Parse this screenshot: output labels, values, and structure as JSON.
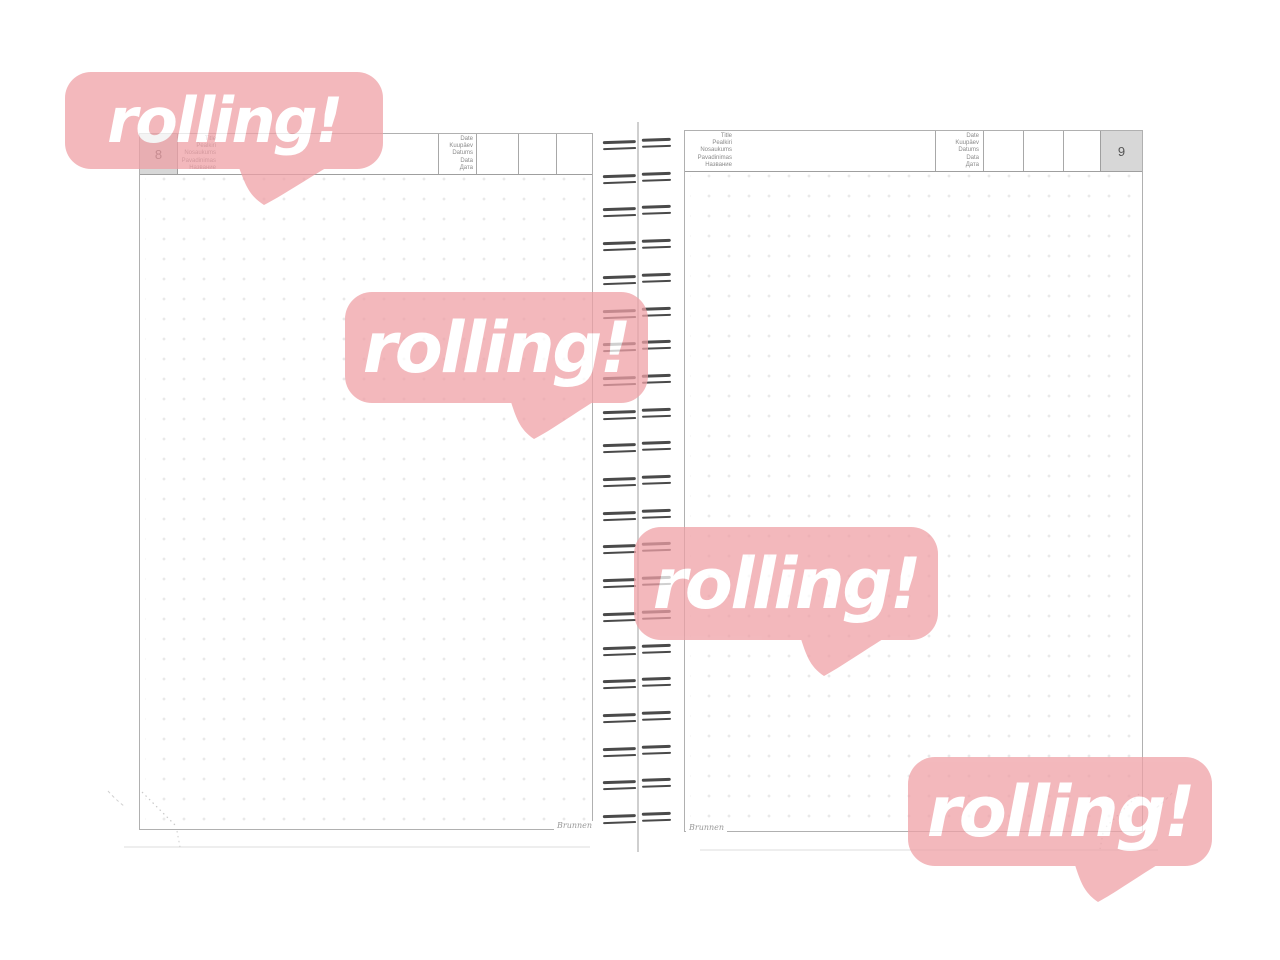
{
  "watermark": {
    "text": "rolling!",
    "bubble_color": "#EFA0A6",
    "text_color": "#FFFFFF",
    "count": 4
  },
  "header_labels": {
    "title_lines": [
      "Title",
      "Pealkiri",
      "Nosaukums",
      "Pavadinimas",
      "Название"
    ],
    "date_lines": [
      "Date",
      "Kuupäev",
      "Datums",
      "Data",
      "Дата"
    ]
  },
  "pages": {
    "left": {
      "number": "8",
      "brand": "Brunnen"
    },
    "right": {
      "number": "9",
      "brand": "Brunnen"
    }
  },
  "number_box_color": "#D7D7D7",
  "spiral": {
    "loop_count": 21
  }
}
